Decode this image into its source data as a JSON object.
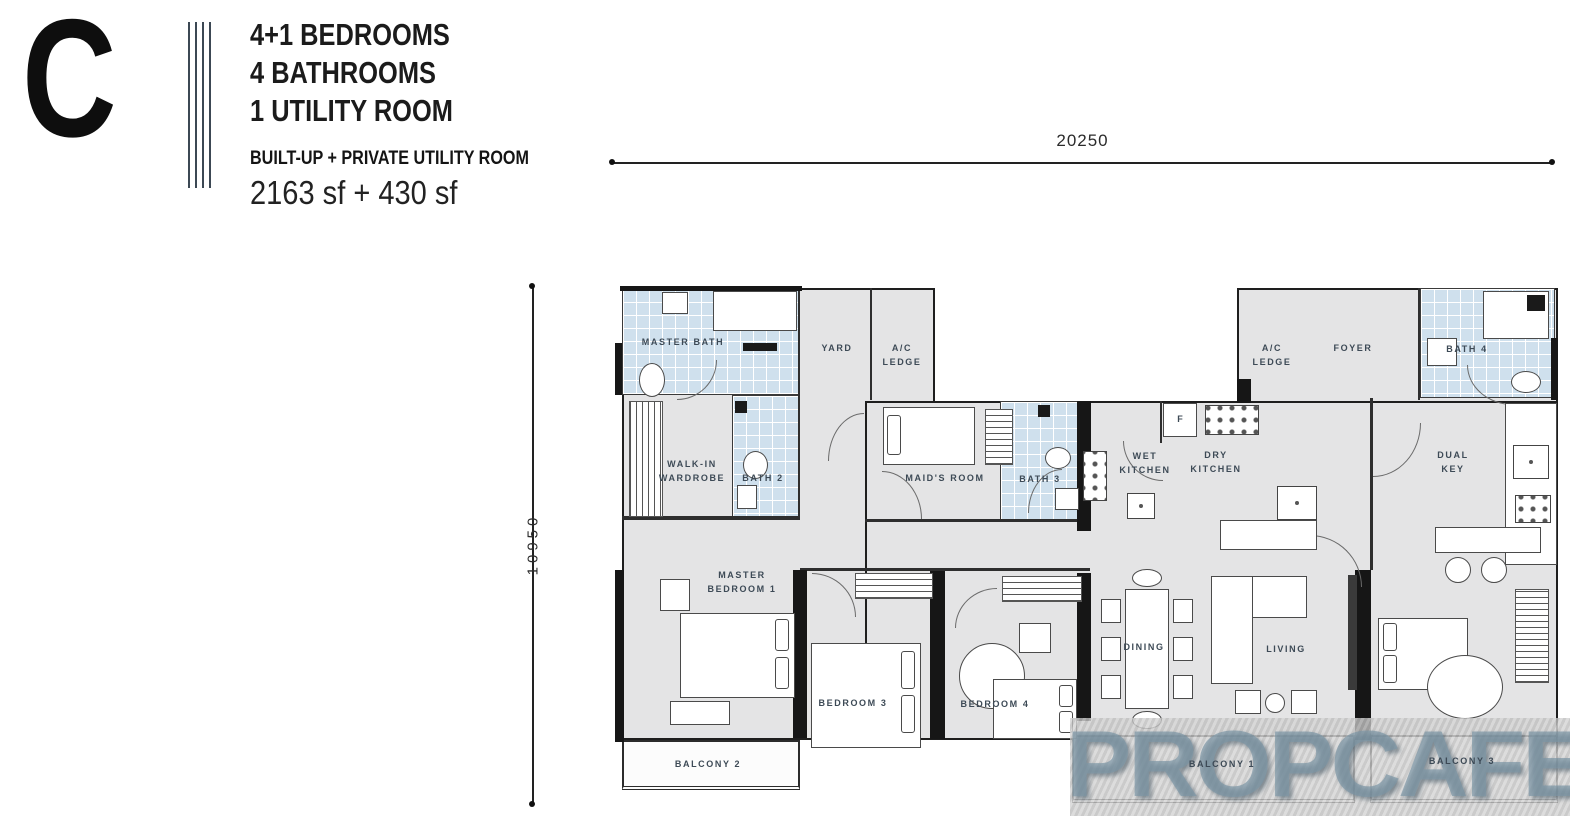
{
  "header": {
    "unit_letter": "C",
    "config_lines": [
      "4+1 BEDROOMS",
      "4 BATHROOMS",
      "1 UTILITY ROOM"
    ],
    "area_title": "BUILT-UP + PRIVATE UTILITY ROOM",
    "area_value": "2163 sf + 430 sf"
  },
  "dimensions": {
    "width": "20250",
    "height": "10950"
  },
  "rooms": {
    "master_bath": "MASTER BATH",
    "yard": "YARD",
    "ac_ledge_left": "A/C\nLEDGE",
    "walk_in_wardrobe": "WALK-IN\nWARDROBE",
    "bath_2": "BATH 2",
    "maids_room": "MAID'S ROOM",
    "bath_3": "BATH 3",
    "wet_kitchen": "WET\nKITCHEN",
    "dry_kitchen": "DRY\nKITCHEN",
    "ac_ledge_right": "A/C\nLEDGE",
    "foyer": "FOYER",
    "bath_4": "BATH 4",
    "dual_key": "DUAL\nKEY",
    "master_bedroom_1": "MASTER\nBEDROOM 1",
    "bedroom_3": "BEDROOM 3",
    "bedroom_4": "BEDROOM 4",
    "dining": "DINING",
    "living": "LIVING",
    "balcony_1": "BALCONY 1",
    "balcony_2": "BALCONY 2",
    "balcony_3": "BALCONY 3"
  },
  "kitchen": {
    "fridge_label": "F"
  },
  "watermark": {
    "text": "PROPCAFE"
  },
  "colors": {
    "room_fill": "#e4e4e5",
    "tile_fill": "#cfe0ed",
    "wall": "#161616",
    "label_text": "#3d4a56",
    "watermark_text": "#7c96a5"
  }
}
